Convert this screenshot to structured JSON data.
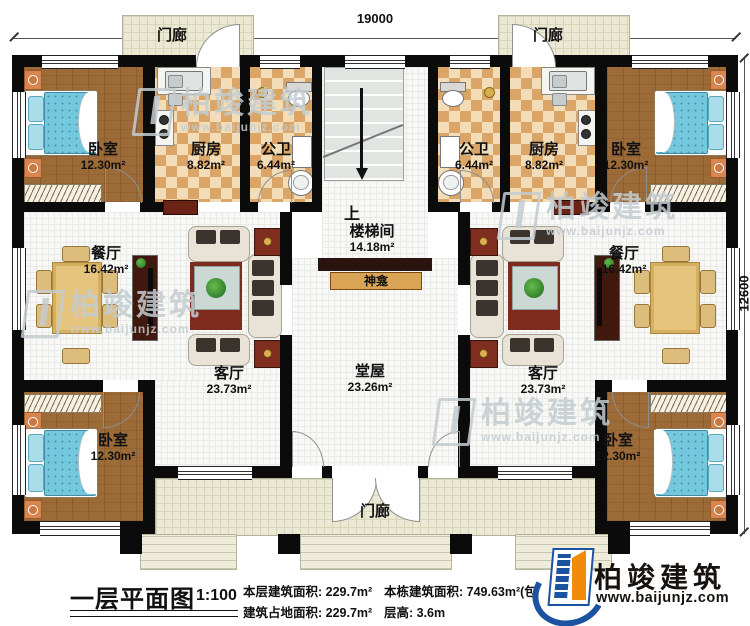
{
  "dimensions": {
    "top": "19000",
    "right": "12600"
  },
  "rooms": {
    "porch_top_left": {
      "name": "门廊"
    },
    "porch_top_right": {
      "name": "门廊"
    },
    "porch_bottom": {
      "name": "门廊"
    },
    "bedroom_tl": {
      "name": "卧室",
      "area": "12.30m²"
    },
    "kitchen_l": {
      "name": "厨房",
      "area": "8.82m²"
    },
    "bath_l": {
      "name": "公卫",
      "area": "6.44m²"
    },
    "bath_r": {
      "name": "公卫",
      "area": "6.44m²"
    },
    "kitchen_r": {
      "name": "厨房",
      "area": "8.82m²"
    },
    "bedroom_tr": {
      "name": "卧室",
      "area": "12.30m²"
    },
    "stairwell": {
      "up": "上",
      "name": "楼梯间",
      "area": "14.18m²"
    },
    "shrine": {
      "name": "神龛"
    },
    "dining_l": {
      "name": "餐厅",
      "area": "16.42m²"
    },
    "dining_r": {
      "name": "餐厅",
      "area": "16.42m²"
    },
    "living_l": {
      "name": "客厅",
      "area": "23.73m²"
    },
    "living_r": {
      "name": "客厅",
      "area": "23.73m²"
    },
    "hall": {
      "name": "堂屋",
      "area": "23.26m²"
    },
    "bedroom_bl": {
      "name": "卧室",
      "area": "12.30m²"
    },
    "bedroom_br": {
      "name": "卧室",
      "area": "12.30m²"
    }
  },
  "footer": {
    "title": "一层平面图",
    "scale": "1:100",
    "stat_floor_area": "本层建筑面积: 229.7m²",
    "stat_footprint": "建筑占地面积: 229.7m²",
    "stat_total": "本栋建筑面积: 749.63m²(包",
    "stat_height": "层高: 3.6m"
  },
  "logo": {
    "brand": "柏竣建筑",
    "url": "www.baijunjz.com"
  },
  "watermark": {
    "brand": "柏竣建筑",
    "url": "www.baijunjz.com"
  }
}
